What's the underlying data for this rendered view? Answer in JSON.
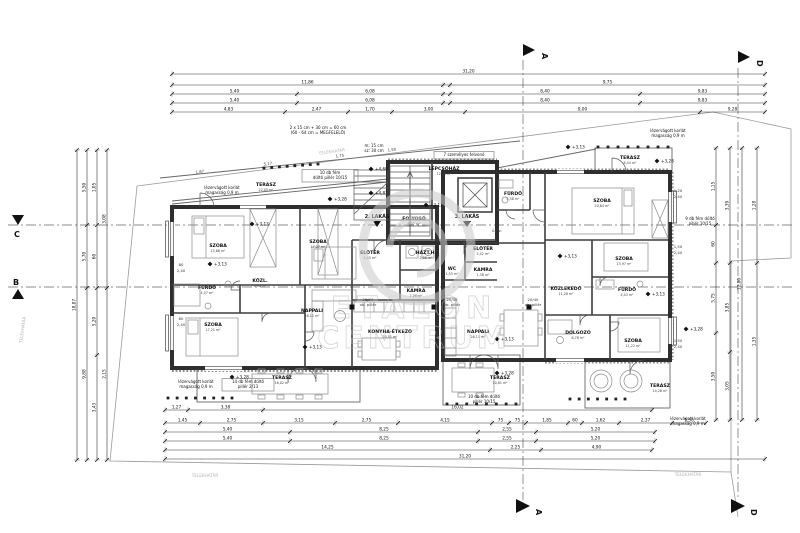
{
  "watermark": {
    "line1": "ETALON",
    "line2": "CENTRUM"
  },
  "markers": {
    "a": "A",
    "b": "B",
    "c": "C",
    "d": "D"
  },
  "rooms": [
    {
      "t": "SZOBA",
      "a": "15,66 m²",
      "x": 218,
      "y": 247
    },
    {
      "t": "SZOBA",
      "a": "17,27 m²",
      "x": 318,
      "y": 243
    },
    {
      "t": "FÜRDŐ",
      "a": "4,57 m²",
      "x": 207,
      "y": 289
    },
    {
      "t": "KÖZL.",
      "a": "3,96 m²",
      "x": 260,
      "y": 282
    },
    {
      "t": "SZOBA",
      "a": "17,21 m²",
      "x": 213,
      "y": 326
    },
    {
      "t": "NAPPALI",
      "a": "28,11 m²",
      "x": 312,
      "y": 312
    },
    {
      "t": "KONYHA-ÉTKEZŐ",
      "a": "20,51 m²",
      "x": 390,
      "y": 333
    },
    {
      "t": "TERASZ",
      "a": "16,02 m²",
      "x": 282,
      "y": 379
    },
    {
      "t": "TERASZ",
      "a": "22,05 m²",
      "x": 266,
      "y": 186
    },
    {
      "t": "LÉPCSŐHÁZ",
      "a": "12,36 m²",
      "x": 444,
      "y": 170
    },
    {
      "t": "FOLYOSÓ",
      "a": "8,07 m²",
      "x": 414,
      "y": 220
    },
    {
      "t": "ELŐTÉR",
      "a": "4,45 m²",
      "x": 370,
      "y": 254
    },
    {
      "t": "HÁZT.H.",
      "a": "2,86 m²",
      "x": 426,
      "y": 254
    },
    {
      "t": "KAMRA",
      "a": "2,28 m²",
      "x": 416,
      "y": 292
    },
    {
      "t": "WC",
      "a": "1,55 m²",
      "x": 452,
      "y": 270
    },
    {
      "t": "KAMRA",
      "a": "1,38 m²",
      "x": 483,
      "y": 271
    },
    {
      "t": "ELŐTÉR",
      "a": "5,42 m²",
      "x": 483,
      "y": 250
    },
    {
      "t": "NAPPALI",
      "a": "26,11 m²",
      "x": 478,
      "y": 333
    },
    {
      "t": "TERASZ",
      "a": "10,81 m²",
      "x": 500,
      "y": 379
    },
    {
      "t": "FÜRDŐ",
      "a": "5,38 m²",
      "x": 513,
      "y": 195
    },
    {
      "t": "SZOBA",
      "a": "20,64 m²",
      "x": 602,
      "y": 202
    },
    {
      "t": "TERASZ",
      "a": "8,44 m²",
      "x": 630,
      "y": 159
    },
    {
      "t": "SZOBA",
      "a": "13,97 m²",
      "x": 624,
      "y": 260
    },
    {
      "t": "KÖZLEKEDŐ",
      "a": "11,28 m²",
      "x": 566,
      "y": 290
    },
    {
      "t": "FÜRDŐ",
      "a": "4,43 m²",
      "x": 627,
      "y": 291
    },
    {
      "t": "DOLGOZÓ",
      "a": "6,78 m²",
      "x": 578,
      "y": 334
    },
    {
      "t": "SZOBA",
      "a": "11,22 m²",
      "x": 633,
      "y": 342
    },
    {
      "t": "TERASZ",
      "a": "14,26 m²",
      "x": 660,
      "y": 387
    }
  ],
  "apartment_tags": [
    {
      "t": "2. LAKÁS",
      "x": 377,
      "y": 218
    },
    {
      "t": "3. LAKÁS",
      "x": 467,
      "y": 218
    }
  ],
  "notes": [
    {
      "x": 318,
      "y": 129,
      "lines": [
        "2 x 15 cm + 30 cm = 60 cm",
        "(60 - 64 cm = MEGFELELŐ)"
      ]
    },
    {
      "x": 374,
      "y": 147,
      "lines": [
        "m: 15 cm",
        "sz: 30 cm"
      ]
    },
    {
      "x": 330,
      "y": 174,
      "lines": [
        "10 db fém",
        "dűltő pillér 10/15"
      ],
      "box": 1,
      "w": 52
    },
    {
      "x": 222,
      "y": 189,
      "lines": [
        "lézervágott korlát",
        "magasság 0,9 m"
      ]
    },
    {
      "x": 668,
      "y": 132,
      "lines": [
        "lézervágott korlát",
        "magasság 0,9 m"
      ]
    },
    {
      "x": 700,
      "y": 220,
      "lines": [
        "9 db fém dűltő",
        "pillér 10/15"
      ]
    },
    {
      "x": 196,
      "y": 383,
      "lines": [
        "lézervágott korlát",
        "magasság 0,9 m"
      ]
    },
    {
      "x": 248,
      "y": 383,
      "lines": [
        "14 db fém dűltő",
        "pillér 2/13"
      ],
      "box": 1,
      "w": 48
    },
    {
      "x": 484,
      "y": 398,
      "lines": [
        "10 db fém dűltő",
        "pillér 10/15"
      ]
    },
    {
      "x": 688,
      "y": 420,
      "lines": [
        "lézervágott korlát",
        "magasság 0,9 m"
      ]
    },
    {
      "x": 464,
      "y": 156,
      "lines": [
        "7 személyes felvonó"
      ],
      "box": 1,
      "w": 56
    }
  ],
  "levels": [
    {
      "x": 252,
      "y": 224,
      "v": "+3,13"
    },
    {
      "x": 210,
      "y": 264,
      "v": "+3,13"
    },
    {
      "x": 568,
      "y": 147,
      "v": "+3,13"
    },
    {
      "x": 371,
      "y": 169,
      "v": "+4,68"
    },
    {
      "x": 371,
      "y": 193,
      "v": "+4,83"
    },
    {
      "x": 330,
      "y": 199,
      "v": "+3,28"
    },
    {
      "x": 657,
      "y": 161,
      "v": "+3,28"
    },
    {
      "x": 497,
      "y": 339,
      "v": "+3,13"
    },
    {
      "x": 497,
      "y": 373,
      "v": "+3,28"
    },
    {
      "x": 305,
      "y": 347,
      "v": "+3,13"
    },
    {
      "x": 648,
      "y": 294,
      "v": "+3,13"
    },
    {
      "x": 686,
      "y": 329,
      "v": "+3,28"
    },
    {
      "x": 232,
      "y": 377,
      "v": "+3,28"
    },
    {
      "x": 560,
      "y": 256,
      "v": "+3,13"
    },
    {
      "x": 426,
      "y": 205,
      "v": "+3,13"
    }
  ],
  "small_texts": [
    {
      "x": 24,
      "y": 330,
      "t": "TELEKHATÁR",
      "r": -82
    },
    {
      "x": 332,
      "y": 153,
      "t": "TELEKHATÁR",
      "r": -8
    },
    {
      "x": 205,
      "y": 477,
      "t": "TELEKHATÁR",
      "r": 0
    },
    {
      "x": 688,
      "y": 476,
      "t": "TELEKHATÁR",
      "r": 0
    },
    {
      "x": 200,
      "y": 173,
      "t": "1,67",
      "r": -6
    },
    {
      "x": 268,
      "y": 165,
      "t": "5,17",
      "r": -6
    },
    {
      "x": 340,
      "y": 157,
      "t": "1,75",
      "r": -6
    },
    {
      "x": 392,
      "y": 151,
      "t": "1,50",
      "r": -6
    },
    {
      "x": 181,
      "y": 266,
      "t": "80",
      "r": 0
    },
    {
      "x": 181,
      "y": 272,
      "t": "2,40",
      "r": 0
    },
    {
      "x": 181,
      "y": 320,
      "t": "80",
      "r": 0
    },
    {
      "x": 181,
      "y": 326,
      "t": "2,40",
      "r": 0
    },
    {
      "x": 678,
      "y": 192,
      "t": "1,20",
      "r": 0
    },
    {
      "x": 678,
      "y": 198,
      "t": "2,40",
      "r": 0
    },
    {
      "x": 678,
      "y": 248,
      "t": "1,50",
      "r": 0
    },
    {
      "x": 678,
      "y": 254,
      "t": "2,40",
      "r": 0
    },
    {
      "x": 678,
      "y": 342,
      "t": "1,50",
      "r": 0
    },
    {
      "x": 678,
      "y": 348,
      "t": "2,40",
      "r": 0
    },
    {
      "x": 368,
      "y": 301,
      "t": "20/40",
      "r": 0
    },
    {
      "x": 368,
      "y": 306,
      "t": "vb. pillér",
      "r": 0
    },
    {
      "x": 452,
      "y": 301,
      "t": "20/40",
      "r": 0
    },
    {
      "x": 452,
      "y": 306,
      "t": "vb. pillér",
      "r": 0
    },
    {
      "x": 533,
      "y": 301,
      "t": "20/40",
      "r": 0
    },
    {
      "x": 533,
      "y": 306,
      "t": "vb. pillér",
      "r": 0
    },
    {
      "x": 497,
      "y": 232,
      "t": "0. sz.",
      "r": 0
    }
  ],
  "pillar_rows": [
    {
      "x1": 264,
      "y1": 168,
      "x2": 318,
      "y2": 164,
      "n": 8
    },
    {
      "x1": 168,
      "y1": 398,
      "x2": 232,
      "y2": 398,
      "n": 8
    },
    {
      "x1": 570,
      "y1": 399,
      "x2": 625,
      "y2": 399,
      "n": 7
    },
    {
      "x1": 598,
      "y1": 147,
      "x2": 668,
      "y2": 147,
      "n": 8
    },
    {
      "x1": 447,
      "y1": 404,
      "x2": 516,
      "y2": 404,
      "n": 8
    }
  ],
  "dims": {
    "h": [
      {
        "y": 74,
        "parts": [
          [
            172,
            765,
            "31,20"
          ]
        ]
      },
      {
        "y": 85,
        "parts": [
          [
            172,
            443,
            "11,86"
          ],
          [
            450,
            765,
            "9,75"
          ]
        ]
      },
      {
        "y": 94,
        "parts": [
          [
            172,
            297,
            "5,40"
          ],
          [
            297,
            443,
            "6,08"
          ],
          [
            450,
            640,
            "8,40"
          ],
          [
            640,
            765,
            "9,83"
          ]
        ]
      },
      {
        "y": 103,
        "parts": [
          [
            172,
            297,
            "5,40"
          ],
          [
            297,
            443,
            "6,08"
          ],
          [
            450,
            640,
            "8,40"
          ],
          [
            640,
            765,
            "9,83"
          ]
        ]
      },
      {
        "y": 112,
        "parts": [
          [
            172,
            285,
            "4,83"
          ],
          [
            285,
            348,
            "2,47"
          ],
          [
            348,
            392,
            "1,70"
          ],
          [
            392,
            465,
            "3,00"
          ],
          [
            465,
            700,
            "9,00"
          ],
          [
            700,
            765,
            "9,28"
          ]
        ]
      },
      {
        "y": 410,
        "parts": [
          [
            165,
            188,
            "1,27"
          ],
          [
            188,
            263,
            "3,38"
          ],
          [
            263,
            652,
            "16,02"
          ]
        ]
      },
      {
        "y": 423,
        "parts": [
          [
            165,
            200,
            "1,45"
          ],
          [
            200,
            263,
            "2,75"
          ],
          [
            263,
            335,
            "3,15"
          ],
          [
            335,
            398,
            "2,75"
          ],
          [
            398,
            492,
            "4,15"
          ],
          [
            492,
            509,
            "75"
          ],
          [
            509,
            526,
            "75"
          ],
          [
            526,
            568,
            "1,85"
          ],
          [
            568,
            582,
            "60"
          ],
          [
            582,
            619,
            "1,62"
          ],
          [
            619,
            672,
            "2,37"
          ],
          [
            672,
            706,
            "1,50"
          ]
        ]
      },
      {
        "y": 432,
        "parts": [
          [
            165,
            290,
            "5,40"
          ],
          [
            290,
            478,
            "8,25"
          ],
          [
            478,
            536,
            "2,55"
          ],
          [
            536,
            655,
            "5,20"
          ]
        ]
      },
      {
        "y": 441,
        "parts": [
          [
            165,
            290,
            "5,40"
          ],
          [
            290,
            478,
            "8,25"
          ],
          [
            478,
            536,
            "2,55"
          ],
          [
            536,
            655,
            "5,20"
          ]
        ]
      },
      {
        "y": 450,
        "parts": [
          [
            165,
            490,
            "14,25"
          ],
          [
            490,
            541,
            "2,25"
          ],
          [
            541,
            652,
            "4,90"
          ]
        ]
      },
      {
        "y": 459,
        "parts": [
          [
            165,
            765,
            "31,20"
          ]
        ]
      }
    ],
    "v": [
      {
        "x": 77,
        "parts": [
          [
            150,
            460,
            "18,87"
          ]
        ]
      },
      {
        "x": 87,
        "parts": [
          [
            150,
            225,
            "5,50"
          ],
          [
            225,
            288,
            "5,70"
          ],
          [
            288,
            460,
            "9,88"
          ]
        ]
      },
      {
        "x": 97,
        "parts": [
          [
            150,
            225,
            "1,05"
          ],
          [
            225,
            288,
            "60"
          ],
          [
            288,
            355,
            "5,20"
          ],
          [
            355,
            460,
            "3,43"
          ]
        ]
      },
      {
        "x": 107,
        "parts": [
          [
            150,
            288,
            "3,08"
          ],
          [
            288,
            460,
            "2,15"
          ]
        ]
      },
      {
        "x": 716,
        "parts": [
          [
            148,
            225,
            "1,15"
          ],
          [
            225,
            263,
            "60"
          ],
          [
            263,
            333,
            "5,75"
          ],
          [
            333,
            420,
            "3,50"
          ]
        ]
      },
      {
        "x": 730,
        "parts": [
          [
            148,
            263,
            "3,39"
          ],
          [
            263,
            352,
            "3,85"
          ],
          [
            352,
            420,
            "3,05"
          ]
        ]
      },
      {
        "x": 742,
        "parts": [
          [
            148,
            420,
            "12,80"
          ]
        ]
      },
      {
        "x": 757,
        "parts": [
          [
            148,
            263,
            "1,28"
          ],
          [
            263,
            420,
            "1,35"
          ]
        ]
      }
    ]
  }
}
